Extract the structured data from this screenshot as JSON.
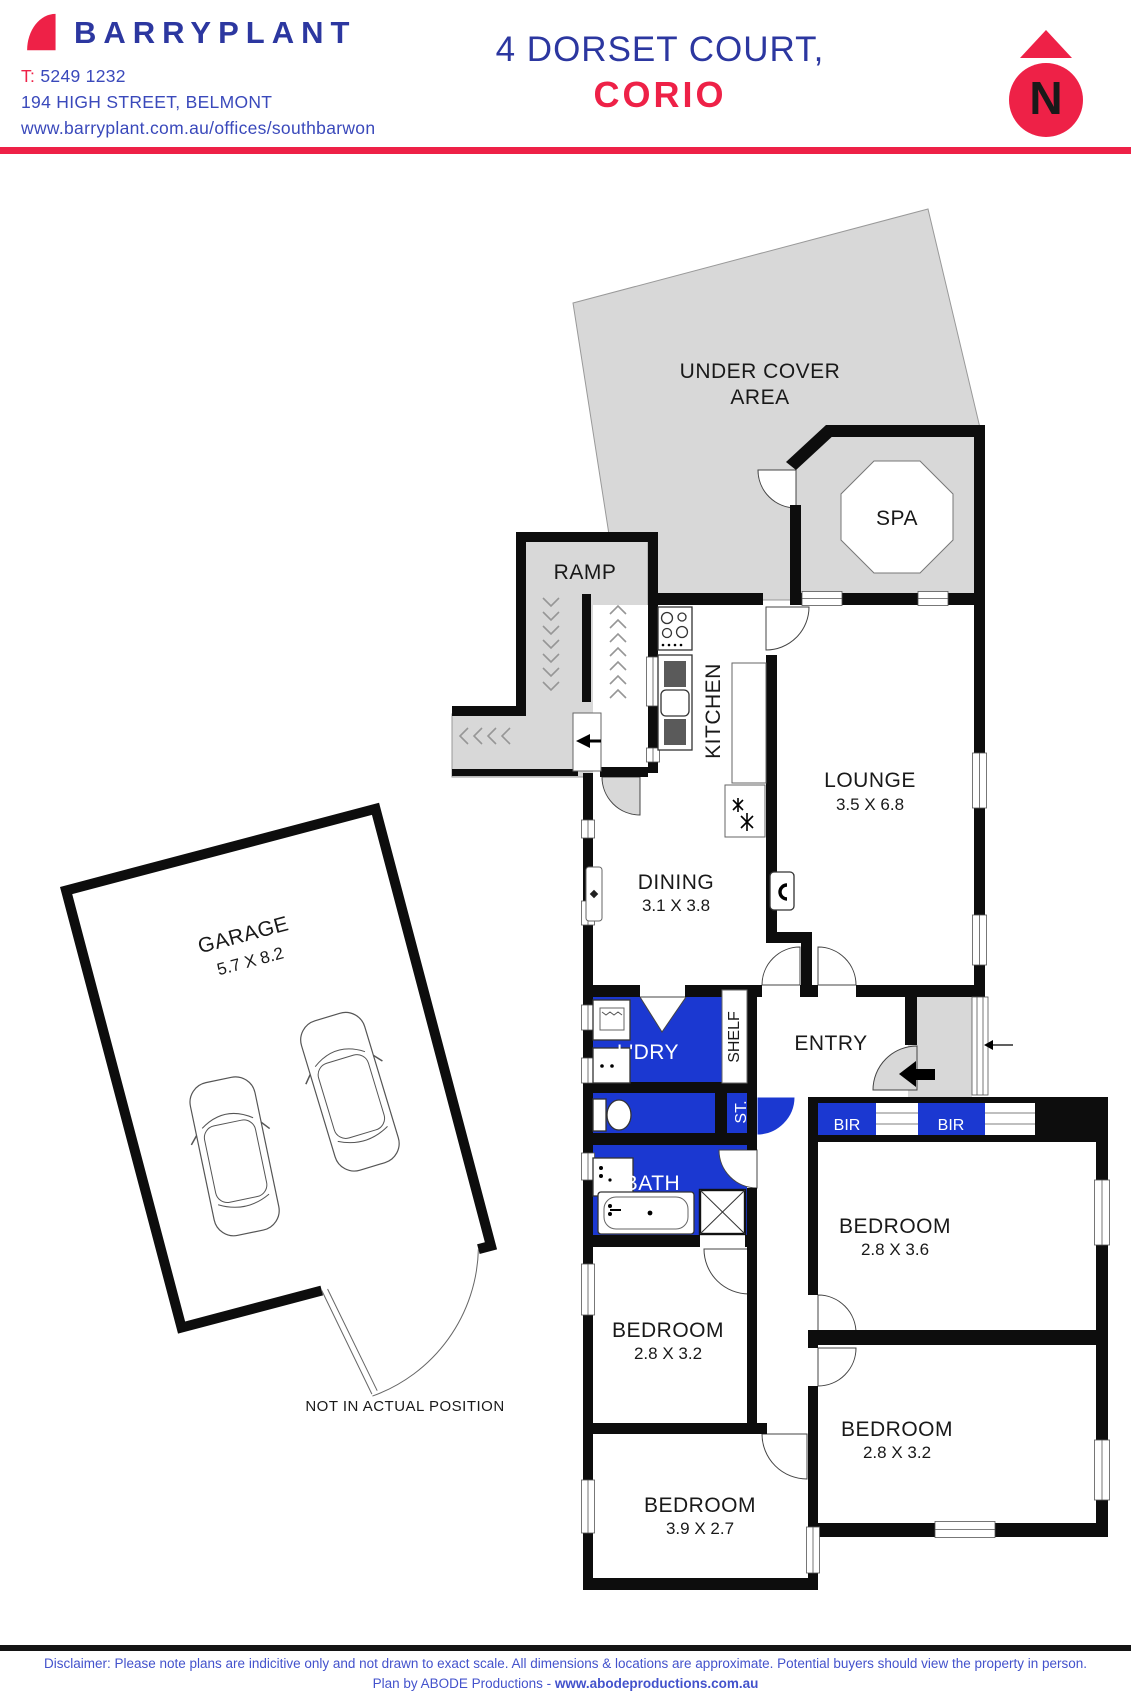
{
  "header": {
    "brand": "BARRYPLANT",
    "phone_label": "T:",
    "phone": "5249 1232",
    "address": "194 HIGH STREET, BELMONT",
    "website": "www.barryplant.com.au/offices/southbarwon"
  },
  "title": {
    "line1": "4 DORSET COURT,",
    "line2": "CORIO"
  },
  "north": {
    "letter": "N"
  },
  "plan": {
    "rooms": {
      "under_cover_1": "UNDER COVER",
      "under_cover_2": "AREA",
      "spa": "SPA",
      "ramp": "RAMP",
      "kitchen": "KITCHEN",
      "lounge": {
        "name": "LOUNGE",
        "dims": "3.5 X 6.8"
      },
      "dining": {
        "name": "DINING",
        "dims": "3.1 X 3.8"
      },
      "garage": {
        "name": "GARAGE",
        "dims": "5.7 X 8.2"
      },
      "laundry": "L'DRY",
      "shelf": "SHELF",
      "entry": "ENTRY",
      "store": "ST.",
      "bir_left": "BIR",
      "bir_right": "BIR",
      "bath": "BATH",
      "bed1": {
        "name": "BEDROOM",
        "dims": "2.8 X 3.6"
      },
      "bed2": {
        "name": "BEDROOM",
        "dims": "2.8 X 3.2"
      },
      "bed3": {
        "name": "BEDROOM",
        "dims": "2.8 X 3.2"
      },
      "bed4": {
        "name": "BEDROOM",
        "dims": "3.9 X 2.7"
      }
    },
    "note": "NOT IN ACTUAL POSITION"
  },
  "footer": {
    "disclaimer": "Disclaimer: Please note plans are indicitive only and not drawn to exact scale. All dimensions & locations are approximate. Potential buyers should view the property in person.",
    "plan_by": "Plan by ABODE Productions - ",
    "url": "www.abodeproductions.com.au"
  },
  "colors": {
    "brand_blue": "#2c37a0",
    "accent_red": "#ee2147",
    "room_blue": "#1b38d1",
    "area_gray": "#d8d8d8"
  }
}
